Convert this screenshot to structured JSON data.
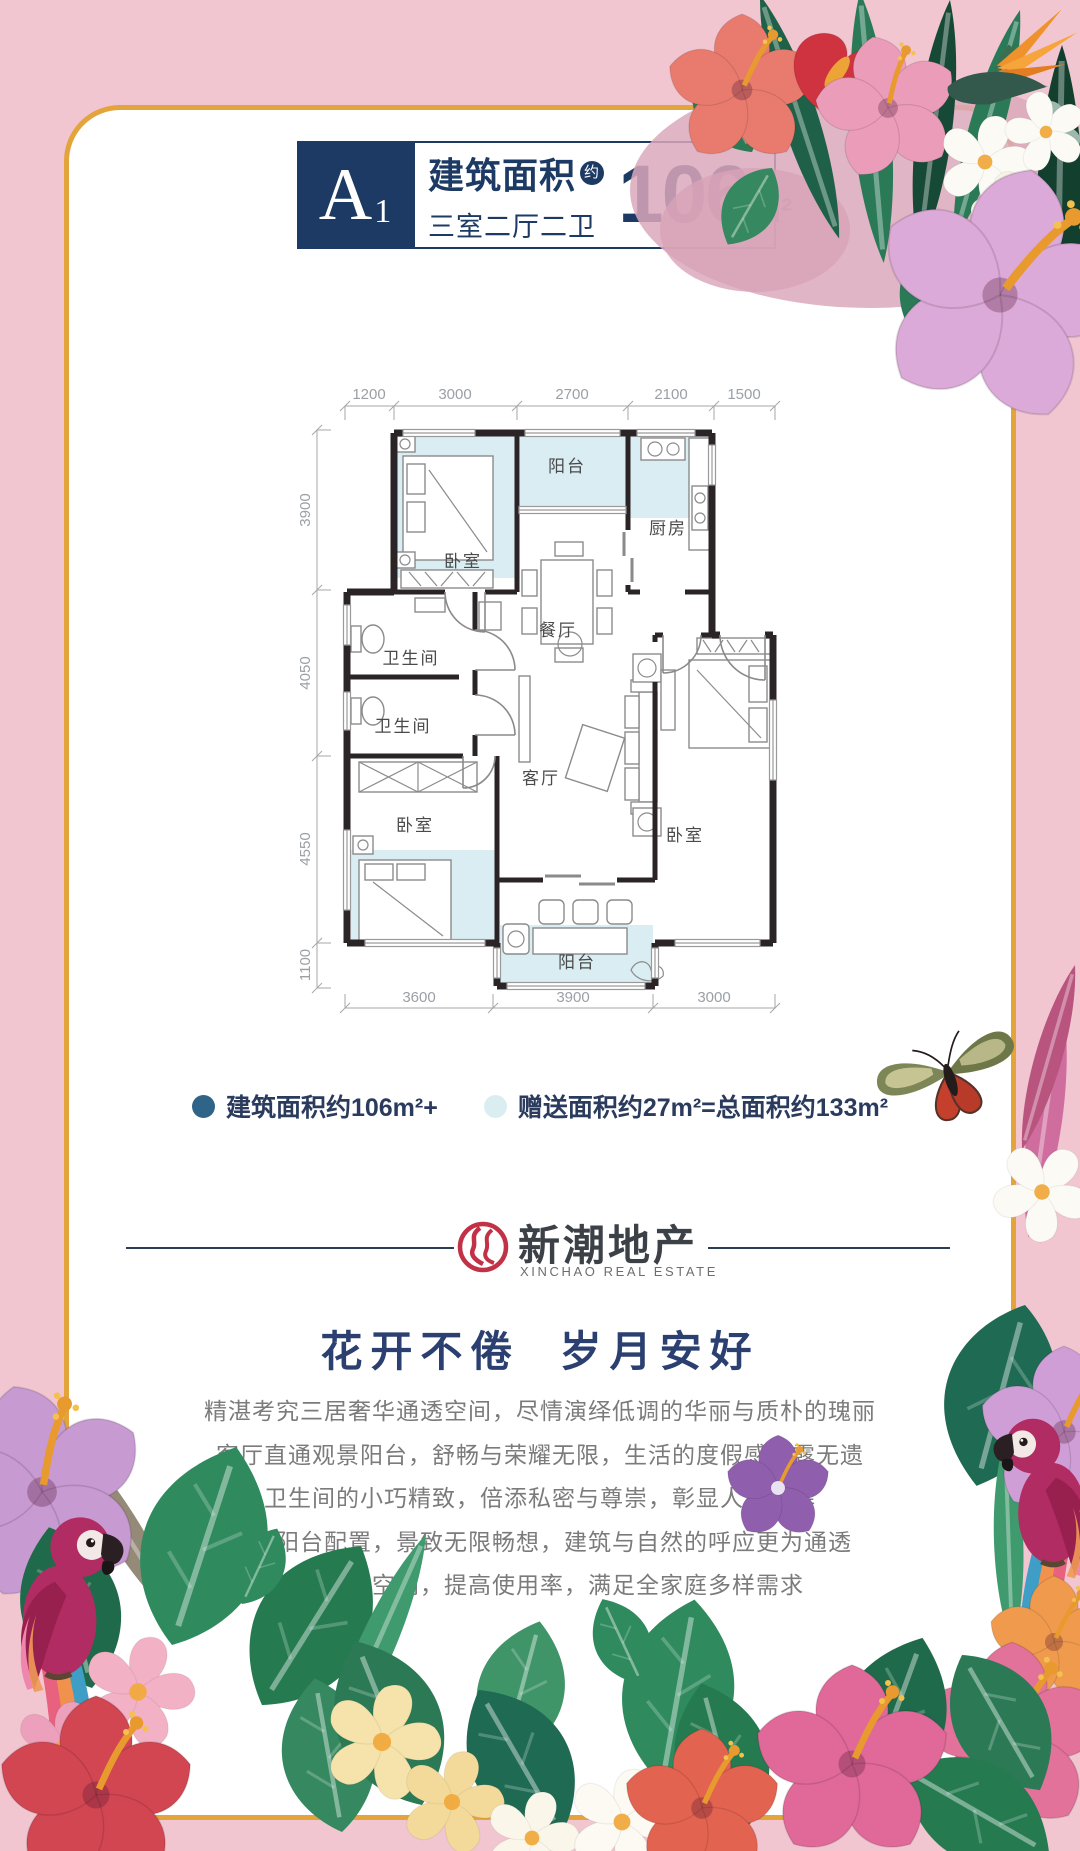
{
  "palette": {
    "background_pink": "#f1c6d1",
    "gold_border": "#e2a43b",
    "navy": "#1c3a63",
    "wall": "#2b2426",
    "gift_area_fill": "#d9edf2",
    "legend_built_dot": "#2f6388",
    "legend_gift_dot": "#daeef2",
    "logo_red": "#c23247",
    "body_text_gray": "#7b7b7b"
  },
  "header": {
    "unit_code": "A",
    "unit_index": "1",
    "area_label": "建筑面积",
    "approx_badge": "约",
    "rooms_spec": "三室二厅二卫",
    "area_value": "106",
    "area_unit": "m²"
  },
  "floor_plan": {
    "dims_top": [
      "1200",
      "3000",
      "2700",
      "2100",
      "1500"
    ],
    "dims_left": [
      "3900",
      "4050",
      "4550",
      "1100"
    ],
    "dims_bottom": [
      "3600",
      "3900",
      "3000"
    ],
    "rooms": [
      {
        "id": "bedroom-top-left",
        "label": "卧室"
      },
      {
        "id": "balcony-top",
        "label": "阳台"
      },
      {
        "id": "kitchen",
        "label": "厨房"
      },
      {
        "id": "dining",
        "label": "餐厅"
      },
      {
        "id": "bathroom-1",
        "label": "卫生间"
      },
      {
        "id": "bathroom-2",
        "label": "卫生间"
      },
      {
        "id": "living",
        "label": "客厅"
      },
      {
        "id": "bedroom-bottom-left",
        "label": "卧室"
      },
      {
        "id": "bedroom-bottom-right",
        "label": "卧室"
      },
      {
        "id": "balcony-bottom",
        "label": "阳台"
      }
    ]
  },
  "legend": {
    "built_label": "建筑面积约106m²+",
    "gift_label": "赠送面积约27m²=总面积约133m²"
  },
  "logo": {
    "name_cn": "新潮地产",
    "name_en": "XINCHAO REAL ESTATE"
  },
  "tagline": "花开不倦  岁月安好",
  "description": [
    "精湛考究三居奢华通透空间，尽情演绎低调的华丽与质朴的瑰丽",
    "客厅直通观景阳台，舒畅与荣耀无限，生活的度假感表露无遗",
    "卫生间的小巧精致，倍添私密与尊崇，彰显人性光辉",
    "超大阳台配置，景致无限畅想，建筑与自然的呼应更为通透",
    "超大赠送空间，提高使用率，满足全家庭多样需求"
  ]
}
